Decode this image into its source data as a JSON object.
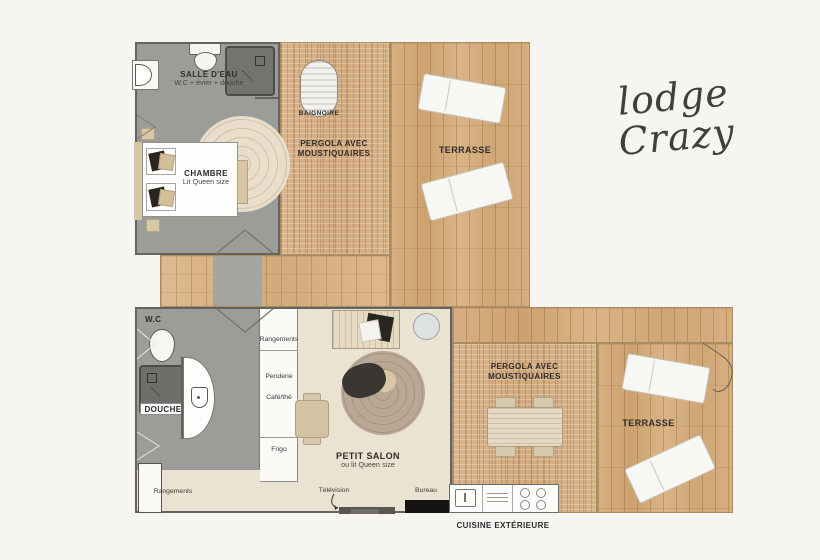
{
  "title": {
    "line1": "lodge",
    "line2": "Crazy"
  },
  "labels": {
    "salle_deau": "SALLE D'EAU",
    "salle_deau_sub": "W.C + évier + douche",
    "baignoire": "BAIGNOIRE",
    "pergola_line1": "PERGOLA AVEC",
    "pergola_line2": "MOUSTIQUAIRES",
    "terrasse": "TERRASSE",
    "chambre": "CHAMBRE",
    "chambre_sub": "Lit Queen size",
    "wc": "W.C",
    "douche": "DOUCHE",
    "rangements": "Rangements",
    "penderie": "Penderie",
    "cafe_the": "Café/thé",
    "frigo": "Frigo",
    "petit_salon": "PETIT SALON",
    "petit_salon_sub": "ou lit Queen size",
    "television": "Télévision",
    "bureau": "Bureau",
    "cuisine_exterieure": "CUISINE EXTÉRIEURE"
  },
  "colors": {
    "wood": "#d3aa7c",
    "wood_deck": "#dab586",
    "pergola_mesh": "#d8b28a",
    "floor_gray": "#9c9c98",
    "floor_cream": "#ebe3d1",
    "shower_dark": "#6c6c68",
    "accent_beige": "#d3c09a",
    "text_dark": "#2e2c29",
    "background": "#f6f5f2"
  }
}
